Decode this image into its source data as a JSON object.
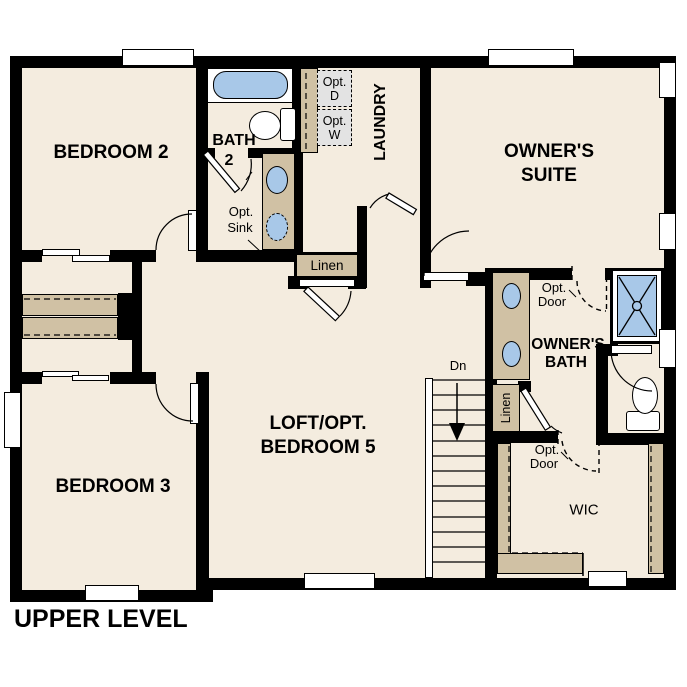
{
  "title": "UPPER LEVEL",
  "rooms": {
    "bedroom2": "BEDROOM 2",
    "bedroom3": "BEDROOM 3",
    "bath2_1": "BATH",
    "bath2_2": "2",
    "laundry": "LAUNDRY",
    "owners_suite_1": "OWNER'S",
    "owners_suite_2": "SUITE",
    "loft_1": "LOFT/OPT.",
    "loft_2": "BEDROOM 5",
    "owners_bath_1": "OWNER'S",
    "owners_bath_2": "BATH",
    "wic": "WIC"
  },
  "labels": {
    "opt_d_1": "Opt.",
    "opt_d_2": "D",
    "opt_w_1": "Opt.",
    "opt_w_2": "W",
    "opt_sink_1": "Opt.",
    "opt_sink_2": "Sink",
    "opt_door_1": "Opt.",
    "opt_door_2": "Door",
    "linen": "Linen",
    "down": "Dn"
  },
  "colors": {
    "floor": "#f4ecdf",
    "wall": "#000000",
    "cabinet_tan": "#d0c1a4",
    "fixture_blue": "#a8c8e8",
    "opt_box_gray": "#e3e3e3"
  }
}
